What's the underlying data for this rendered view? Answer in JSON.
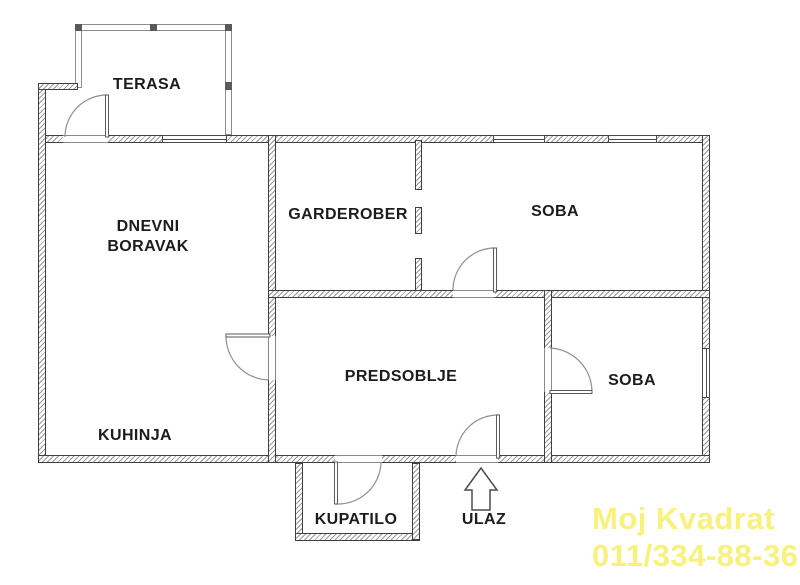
{
  "plan_title": "Apartment floor plan",
  "rooms": {
    "terasa": "TERASA",
    "dnevni_boravak": "DNEVNI\nBORAVAK",
    "garderober": "GARDEROBER",
    "soba_top": "SOBA",
    "predsoblje": "PREDSOBLJE",
    "kuhinja": "KUHINJA",
    "kupatilo": "KUPATILO",
    "soba_right": "SOBA",
    "ulaz": "ULAZ"
  },
  "watermark": {
    "line1": "Moj Kvadrat",
    "line2": "011/334-88-36",
    "color": "#f8f17c"
  },
  "colors": {
    "wall_outline": "#3f3f3f",
    "wall_hatch": "#989898",
    "door_arc": "#8f8f8f",
    "label_text": "#1c1c1c"
  }
}
